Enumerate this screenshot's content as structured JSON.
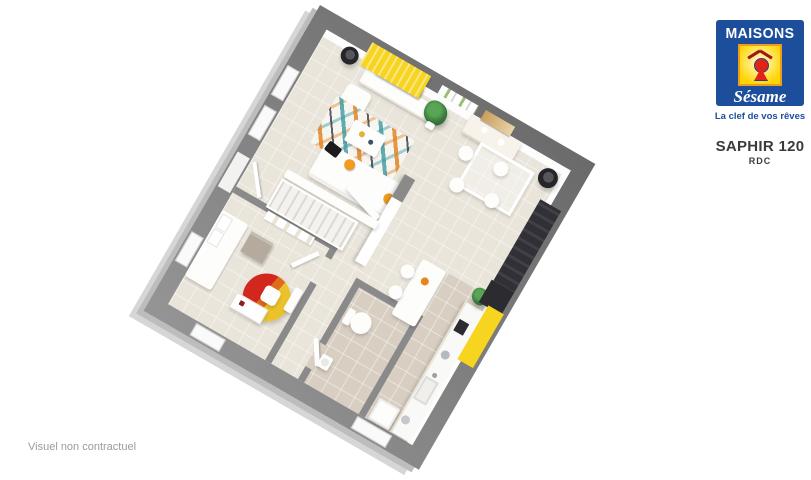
{
  "logo": {
    "brand_line1": "MAISONS",
    "brand_line2": "Sésame",
    "tagline": "La clef de vos rêves",
    "colors": {
      "blue": "#1d4e9b",
      "yellow": "#ffd403",
      "border_orange": "#ee9c1b",
      "red": "#e2231a"
    }
  },
  "title": {
    "model": "SAPHIR 120",
    "floor": "RDC"
  },
  "footnote": "Visuel non contractuel",
  "plan": {
    "colors": {
      "outer_wall": "#7d7d7d",
      "interior_wall": "#8a8a8a",
      "floor": "#eae5db",
      "kitchen_wc_floor": "#d8cfc2",
      "accent_yellow": "#f6d41f",
      "slab_shadow": "#d6d6d6"
    }
  }
}
